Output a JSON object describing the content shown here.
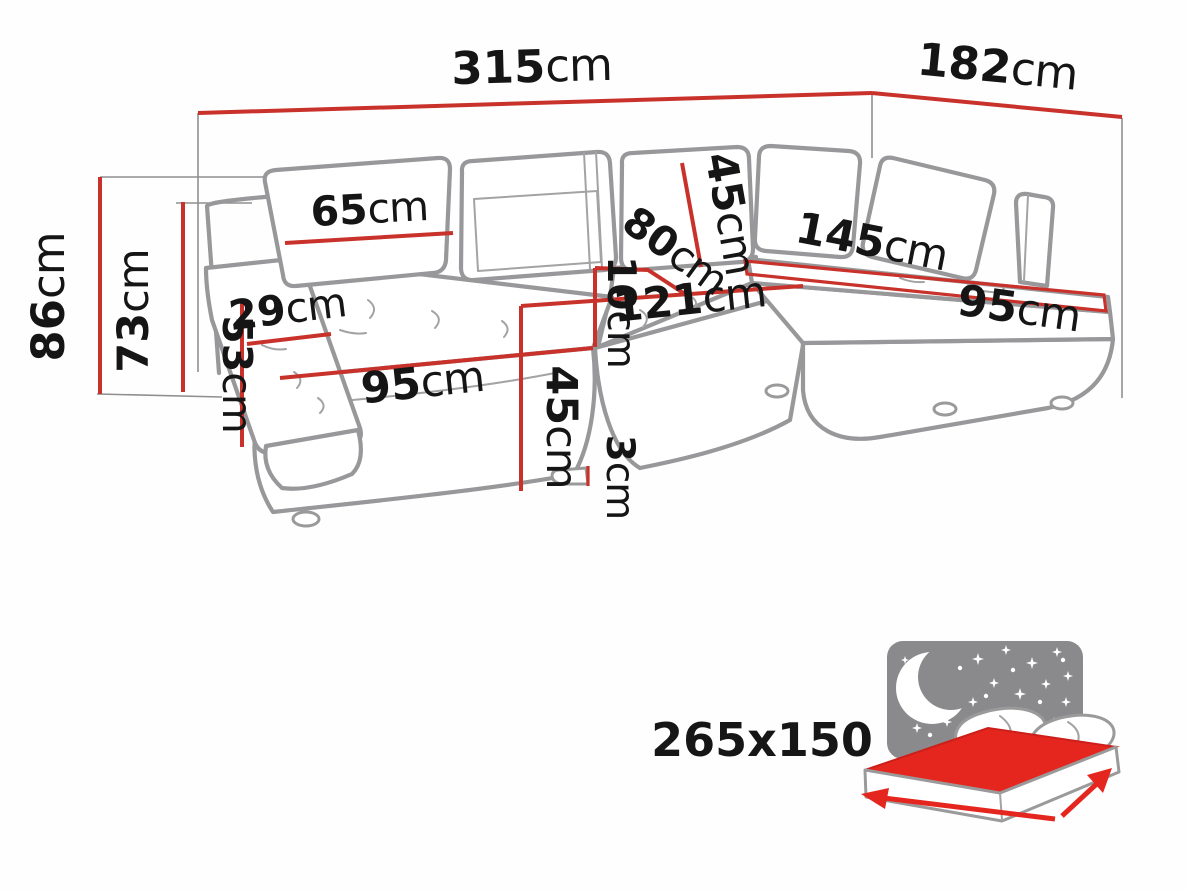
{
  "diagram_type": "corner-sofa-dimension-diagram",
  "colors": {
    "dimension_red": "#c8322b",
    "sofa_outline_gray": "#98989b",
    "label_text": "#151515",
    "bed_icon_gray": "#8a8a8c",
    "bed_icon_red": "#e5261f"
  },
  "dims": {
    "d315": {
      "value": "315",
      "unit": "cm"
    },
    "d182": {
      "value": "182",
      "unit": "cm"
    },
    "d86": {
      "value": "86",
      "unit": "cm"
    },
    "d73": {
      "value": "73",
      "unit": "cm"
    },
    "d53": {
      "value": "53",
      "unit": "cm"
    },
    "d29": {
      "value": "29",
      "unit": "cm"
    },
    "d65": {
      "value": "65",
      "unit": "cm"
    },
    "d95_left": {
      "value": "95",
      "unit": "cm"
    },
    "d45_left": {
      "value": "45",
      "unit": "cm"
    },
    "d3": {
      "value": "3",
      "unit": "cm"
    },
    "d45_back": {
      "value": "45",
      "unit": "cm"
    },
    "d80": {
      "value": "80",
      "unit": "cm"
    },
    "d10": {
      "value": "10",
      "unit": "cm"
    },
    "d121": {
      "value": "121",
      "unit": "cm"
    },
    "d145": {
      "value": "145",
      "unit": "cm"
    },
    "d95_right": {
      "value": "95",
      "unit": "cm"
    }
  },
  "sleeping_area": {
    "label": "265x150"
  }
}
